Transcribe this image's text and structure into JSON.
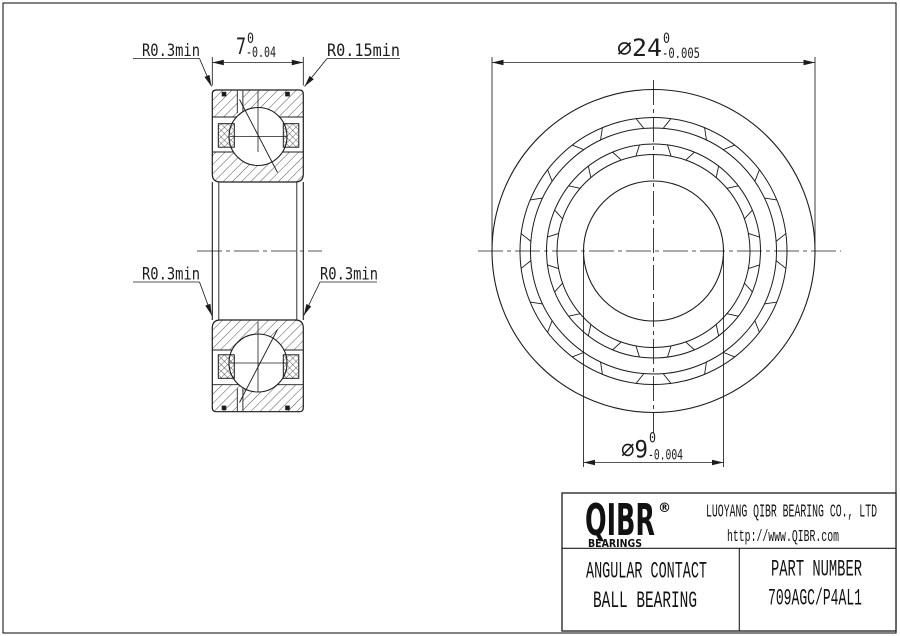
{
  "drawing": {
    "section_view": {
      "width_dim": {
        "value": "7",
        "upper": "0",
        "lower": "-0.04"
      },
      "radius_top_left": "R0.3min",
      "radius_top_right": "R0.15min",
      "radius_mid_left": "R0.3min",
      "radius_mid_right": "R0.3min"
    },
    "front_view": {
      "outer_dim": {
        "value": "∅24",
        "upper": "0",
        "lower": "-0.005"
      },
      "bore_dim": {
        "value": "∅9",
        "upper": "0",
        "lower": "-0.004"
      }
    }
  },
  "title_block": {
    "logo": "QIBR",
    "logo_reg": "®",
    "logo_sub": "BEARINGS",
    "company": "LUOYANG QIBR BEARING CO., LTD",
    "website": "http://www.QIBR.com",
    "product_line1": "ANGULAR CONTACT",
    "product_line2": "BALL BEARING",
    "part_number_label": "PART NUMBER",
    "part_number": "709AGC/P4AL1"
  },
  "colors": {
    "line": "#1c1c1c",
    "background": "#ffffff"
  }
}
